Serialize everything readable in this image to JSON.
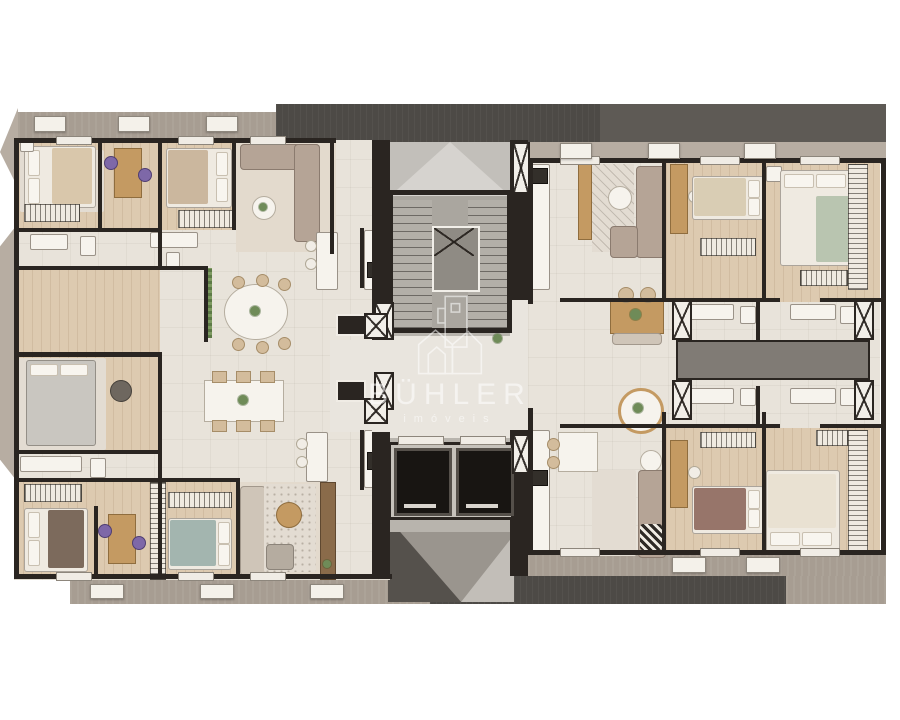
{
  "watermark": {
    "title": "BÜHLER",
    "subtitle": "imóveis",
    "logo_icon": "buhler-house-building-outline"
  },
  "palette": {
    "background": "#ffffff",
    "floor": "#e8e3da",
    "floor_warm": "#e3dacd",
    "wood": "#ddcab0",
    "wood_dark": "#c49a62",
    "wall": "#2a2521",
    "band": "#a79d92",
    "band_light": "#b7ada2",
    "charcoal": "#4d4a46",
    "charcoal_light": "#5e5a55",
    "roof": "#c2bfba",
    "core_floor": "#b8b4ad",
    "elevator": "#181512",
    "sofa": "#b5a496",
    "sofa_light": "#cfc5b8",
    "bed_white": "#efeae1",
    "bed_tan": "#d9c7ab",
    "bed_gray": "#c9c6c0",
    "bed_teal": "#a3b5af",
    "bed_green": "#b9c5b0",
    "bed_brown": "#7c6a5c",
    "bed_maroon": "#97756a",
    "rug": "#e3dcd2",
    "closet": "#efeae1",
    "plant": "#6f8b58",
    "accent_purple": "#7e68a8",
    "white_fix": "#f6f3ed",
    "void": "#807b75",
    "watermark": "#ffffff"
  },
  "plan": {
    "type": "residential floor plan render, top view",
    "core": {
      "features": [
        "stairwell",
        "elevator",
        "elevator",
        "service shafts"
      ]
    },
    "units": [
      {
        "id": "upper-left",
        "rooms": [
          "bedroom",
          "home office",
          "bedroom",
          "living",
          "bathrooms",
          "third bedroom",
          "dining",
          "kitchen",
          "balcony"
        ]
      },
      {
        "id": "lower-left",
        "rooms": [
          "master bedroom",
          "bathroom",
          "bedroom",
          "home office",
          "bedroom",
          "living",
          "dining",
          "kitchen",
          "balcony"
        ]
      },
      {
        "id": "upper-right",
        "rooms": [
          "kitchen",
          "living",
          "dining",
          "bedroom",
          "master bedroom",
          "bathrooms",
          "wardrobe"
        ]
      },
      {
        "id": "lower-right",
        "rooms": [
          "kitchen",
          "dining",
          "living",
          "bedroom",
          "master bedroom",
          "bathrooms",
          "wardrobe"
        ]
      }
    ]
  }
}
